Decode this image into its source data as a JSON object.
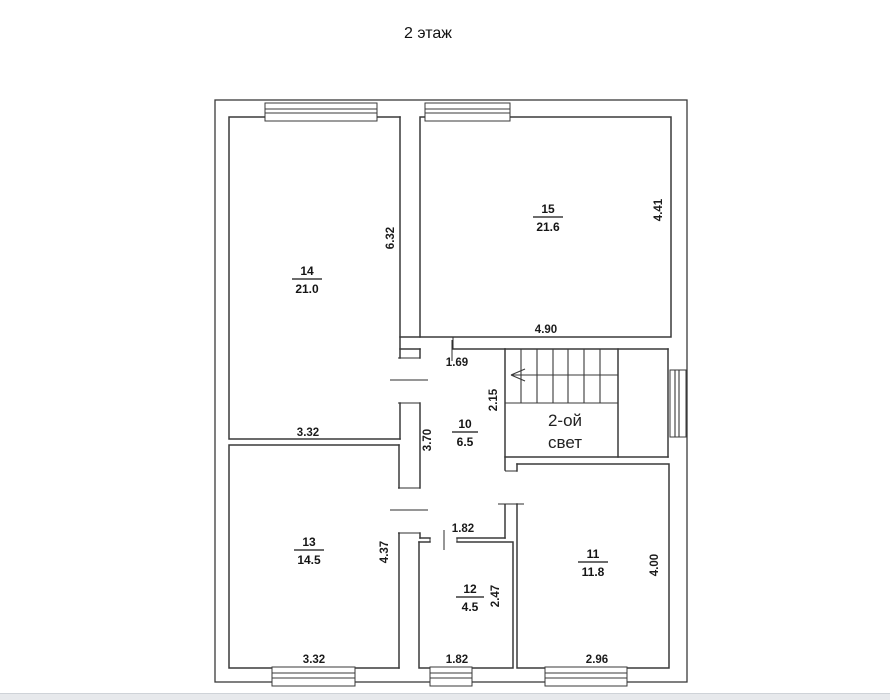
{
  "page": {
    "title": "2  этаж"
  },
  "plan": {
    "rooms": [
      {
        "number": "14",
        "area": "21.0"
      },
      {
        "number": "15",
        "area": "21.6"
      },
      {
        "number": "10",
        "area": "6.5"
      },
      {
        "number": "13",
        "area": "14.5"
      },
      {
        "number": "12",
        "area": "4.5"
      },
      {
        "number": "11",
        "area": "11.8"
      }
    ],
    "void_label": {
      "line1": "2-ой",
      "line2": "свет"
    },
    "dims": {
      "r14_h": "6.32",
      "r14_w": "3.32",
      "r15_h": "4.41",
      "r15_w": "4.90",
      "hall_w_top": "1.69",
      "hall_h": "3.70",
      "hall_w_bottom": "1.82",
      "stair_h": "2.15",
      "r13_h": "4.37",
      "r13_w": "3.32",
      "r12_h": "2.47",
      "r12_w": "1.82",
      "r11_h": "4.00",
      "r11_w": "2.96"
    }
  }
}
